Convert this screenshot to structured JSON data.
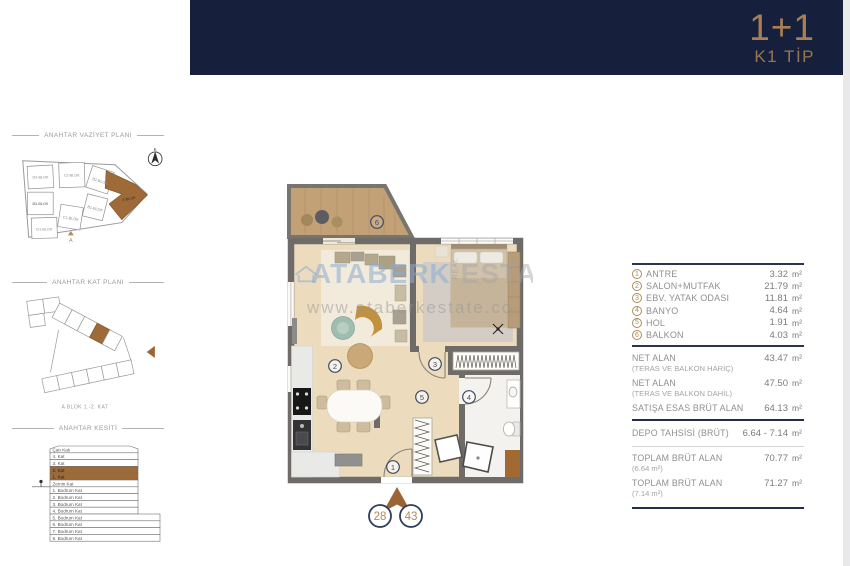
{
  "header": {
    "unit_type": "1+1",
    "plan_code": "K1 TİP"
  },
  "sidebar": {
    "site_plan": {
      "title": "ANAHTAR VAZİYET PLANI",
      "blocks": [
        "D3-BLOK",
        "C2-BLOK",
        "B2-BLOK",
        "D2-BLOK",
        "B1-BLOK",
        "C1-BLOK",
        "D1-BLOK"
      ],
      "highlighted_block": "A-BLOK",
      "compass_label": "K",
      "entrance_marker": "A"
    },
    "key_plan": {
      "title": "ANAHTAR KAT PLANI",
      "caption": "A BLOK 1.-2. KAT"
    },
    "section": {
      "title": "ANAHTAR KESİTİ",
      "floors": [
        "Çatı Katı",
        "4. Kat",
        "3. Kat",
        "2. Kat",
        "1. Kat",
        "Zemin Kat",
        "1. Bodrum Kat",
        "2. Bodrum Kat",
        "3. Bodrum Kat",
        "4. Bodrum Kat",
        "5. Bodrum Kat",
        "6. Bodrum Kat",
        "7. Bodrum Kat",
        "8. Bodrum Kat"
      ],
      "highlighted_floors": [
        "2. Kat",
        "1. Kat"
      ]
    }
  },
  "floor_plan": {
    "room_markers": [
      "1",
      "2",
      "3",
      "4",
      "5",
      "6"
    ],
    "unit_circles": [
      "28",
      "43"
    ],
    "watermark": {
      "brand": "ATABERK",
      "vertical": "REAL",
      "suffix": "ESTATE",
      "url": "www.ataberkestate.co"
    }
  },
  "areas": {
    "rooms": [
      {
        "no": "1",
        "name": "ANTRE",
        "value": "3.32",
        "unit": "m²"
      },
      {
        "no": "2",
        "name": "SALON+MUTFAK",
        "value": "21.79",
        "unit": "m²"
      },
      {
        "no": "3",
        "name": "EBV. YATAK ODASI",
        "value": "11.81",
        "unit": "m²"
      },
      {
        "no": "4",
        "name": "BANYO",
        "value": "4.64",
        "unit": "m²"
      },
      {
        "no": "5",
        "name": "HOL",
        "value": "1.91",
        "unit": "m²"
      },
      {
        "no": "6",
        "name": "BALKON",
        "value": "4.03",
        "unit": "m²"
      }
    ],
    "summary": [
      {
        "name": "NET ALAN",
        "sub": "(TERAS VE BALKON HARİÇ)",
        "value": "43.47",
        "unit": "m²"
      },
      {
        "name": "NET ALAN",
        "sub": "(TERAS VE BALKON DAHİL)",
        "value": "47.50",
        "unit": "m²"
      },
      {
        "name": "SATIŞA ESAS BRÜT ALAN",
        "sub": "",
        "value": "64.13",
        "unit": "m²"
      },
      {
        "name": "DEPO TAHSİSİ (BRÜT)",
        "sub": "",
        "value": "6.64 - 7.14",
        "unit": "m²"
      },
      {
        "name": "TOPLAM BRÜT ALAN",
        "sub": "(6.64 m²)",
        "value": "70.77",
        "unit": "m²"
      },
      {
        "name": "TOPLAM BRÜT ALAN",
        "sub": "(7.14 m²)",
        "value": "71.27",
        "unit": "m²"
      }
    ]
  },
  "colors": {
    "navy": "#16203c",
    "gold": "#a87e54",
    "brown": "#9c6433",
    "wall": "#6f6b68",
    "wood": "#ecdcbd",
    "balcony_wood": "#c2a176"
  }
}
